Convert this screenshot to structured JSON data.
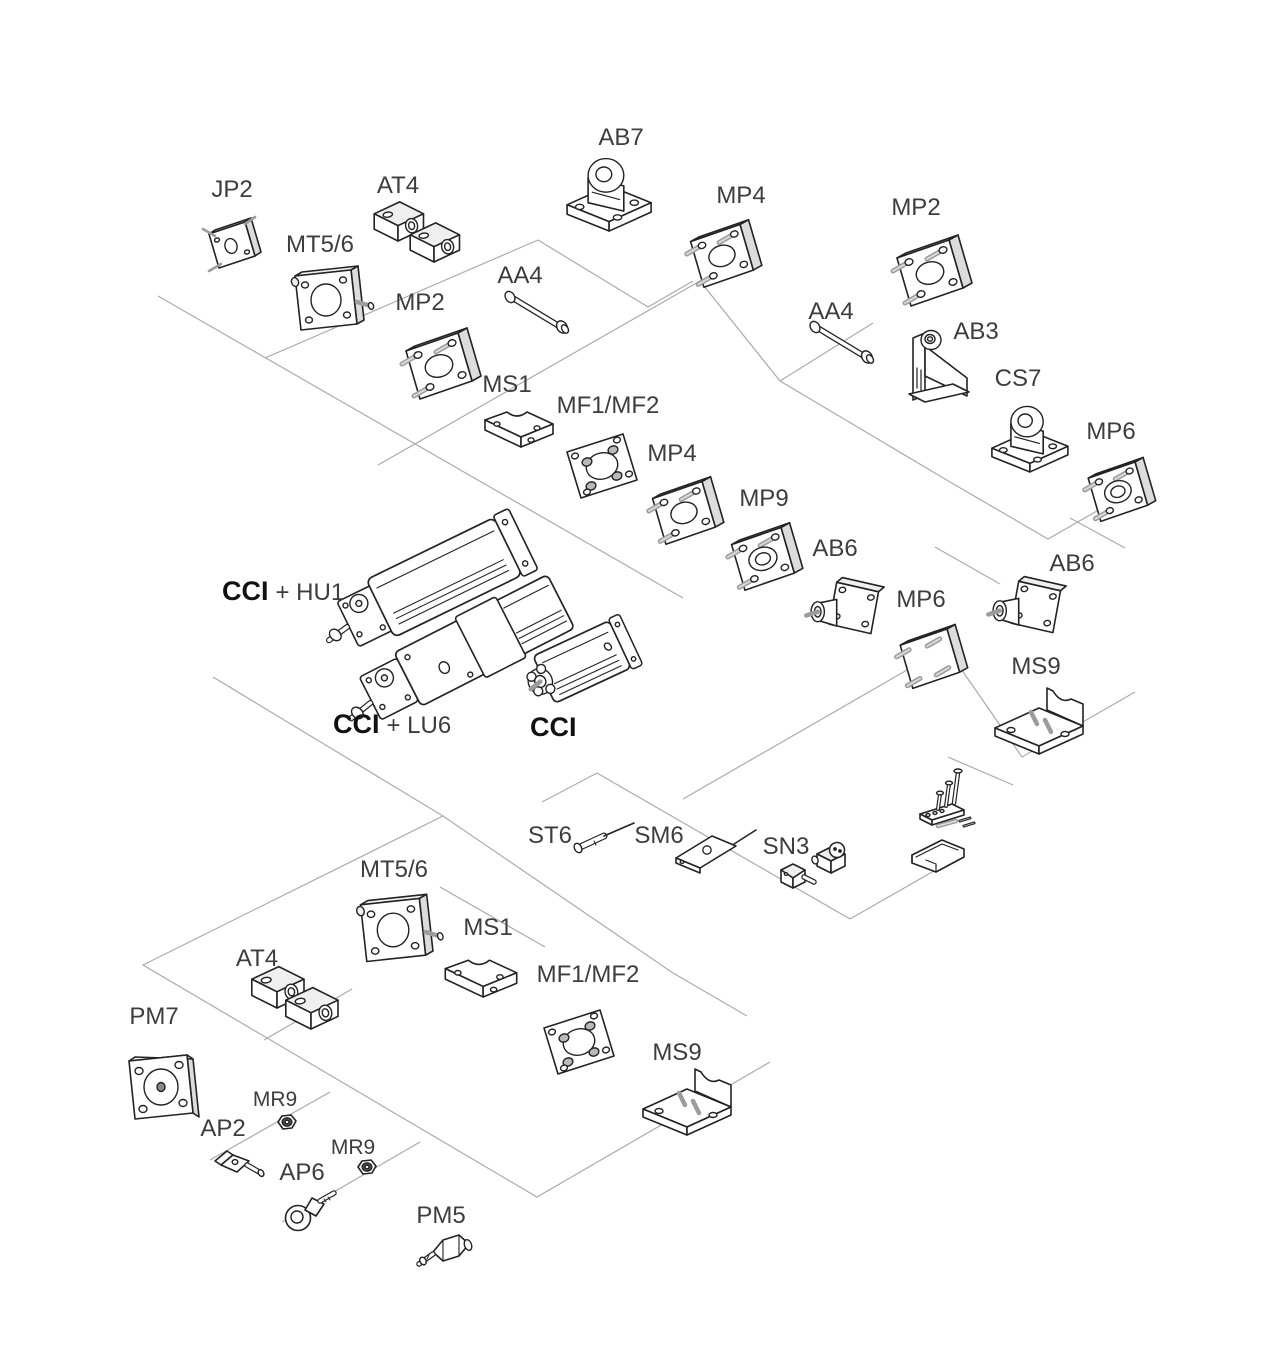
{
  "canvas": {
    "width": 1280,
    "height": 1347,
    "background": "#ffffff"
  },
  "style": {
    "connector_color": "#ababab",
    "outline_color": "#232323",
    "label_color": "#3d3d3d",
    "bold_label_color": "#111111",
    "label_font_size": 24,
    "small_label_font_size": 21,
    "bold_label_font_size": 27,
    "shade_light": "#efefef",
    "shade_mid": "#dcdcdc",
    "metal_gray": "#9c9c9c"
  },
  "labels": [
    {
      "id": "jp2",
      "text": "JP2",
      "x": 232,
      "y": 197,
      "anchor": "middle"
    },
    {
      "id": "mt56-top",
      "text": "MT5/6",
      "x": 320,
      "y": 252,
      "anchor": "middle"
    },
    {
      "id": "at4-top",
      "text": "AT4",
      "x": 398,
      "y": 193,
      "anchor": "middle"
    },
    {
      "id": "ab7",
      "text": "AB7",
      "x": 621,
      "y": 145,
      "anchor": "middle"
    },
    {
      "id": "mp4-top",
      "text": "MP4",
      "x": 741,
      "y": 203,
      "anchor": "middle"
    },
    {
      "id": "mp2-topright",
      "text": "MP2",
      "x": 916,
      "y": 215,
      "anchor": "middle"
    },
    {
      "id": "aa4-left",
      "text": "AA4",
      "x": 520,
      "y": 283,
      "anchor": "middle"
    },
    {
      "id": "mp2-left",
      "text": "MP2",
      "x": 420,
      "y": 310,
      "anchor": "middle"
    },
    {
      "id": "aa4-right",
      "text": "AA4",
      "x": 831,
      "y": 319,
      "anchor": "middle"
    },
    {
      "id": "ab3",
      "text": "AB3",
      "x": 976,
      "y": 339,
      "anchor": "middle"
    },
    {
      "id": "cs7",
      "text": "CS7",
      "x": 1018,
      "y": 386,
      "anchor": "middle"
    },
    {
      "id": "mp6-right",
      "text": "MP6",
      "x": 1111,
      "y": 439,
      "anchor": "middle"
    },
    {
      "id": "ms1-top",
      "text": "MS1",
      "x": 507,
      "y": 392,
      "anchor": "middle"
    },
    {
      "id": "mf12-top",
      "text": "MF1/MF2",
      "x": 608,
      "y": 413,
      "anchor": "middle"
    },
    {
      "id": "mp4-mid",
      "text": "MP4",
      "x": 672,
      "y": 461,
      "anchor": "middle"
    },
    {
      "id": "mp9",
      "text": "MP9",
      "x": 764,
      "y": 506,
      "anchor": "middle"
    },
    {
      "id": "ab6-mid",
      "text": "AB6",
      "x": 835,
      "y": 556,
      "anchor": "middle"
    },
    {
      "id": "mp6-mid",
      "text": "MP6",
      "x": 921,
      "y": 607,
      "anchor": "middle"
    },
    {
      "id": "ab6-right",
      "text": "AB6",
      "x": 1072,
      "y": 571,
      "anchor": "middle"
    },
    {
      "id": "ms9-right",
      "text": "MS9",
      "x": 1036,
      "y": 674,
      "anchor": "middle"
    },
    {
      "id": "cci-hu1",
      "segments": [
        {
          "text": "CCI",
          "bold": true
        },
        {
          "text": "+ HU1",
          "bold": false
        }
      ],
      "x": 222,
      "y": 600,
      "anchor": "start"
    },
    {
      "id": "cci-lu6",
      "segments": [
        {
          "text": "CCI",
          "bold": true
        },
        {
          "text": "+ LU6",
          "bold": false
        }
      ],
      "x": 333,
      "y": 733,
      "anchor": "start"
    },
    {
      "id": "cci",
      "segments": [
        {
          "text": "CCI",
          "bold": true
        }
      ],
      "x": 530,
      "y": 736,
      "anchor": "start"
    },
    {
      "id": "st6",
      "text": "ST6",
      "x": 550,
      "y": 843,
      "anchor": "middle"
    },
    {
      "id": "sm6",
      "text": "SM6",
      "x": 659,
      "y": 843,
      "anchor": "middle"
    },
    {
      "id": "sn3",
      "text": "SN3",
      "x": 786,
      "y": 854,
      "anchor": "middle"
    },
    {
      "id": "mt56-bot",
      "text": "MT5/6",
      "x": 394,
      "y": 877,
      "anchor": "middle"
    },
    {
      "id": "ms1-bot",
      "text": "MS1",
      "x": 488,
      "y": 935,
      "anchor": "middle"
    },
    {
      "id": "at4-bot",
      "text": "AT4",
      "x": 257,
      "y": 966,
      "anchor": "middle"
    },
    {
      "id": "pm7",
      "text": "PM7",
      "x": 154,
      "y": 1024,
      "anchor": "middle"
    },
    {
      "id": "mr9-1",
      "text": "MR9",
      "x": 275,
      "y": 1106,
      "anchor": "middle",
      "size": "small"
    },
    {
      "id": "ap2",
      "text": "AP2",
      "x": 223,
      "y": 1136,
      "anchor": "middle"
    },
    {
      "id": "mr9-2",
      "text": "MR9",
      "x": 353,
      "y": 1154,
      "anchor": "middle",
      "size": "small"
    },
    {
      "id": "ap6",
      "text": "AP6",
      "x": 302,
      "y": 1180,
      "anchor": "middle"
    },
    {
      "id": "pm5",
      "text": "PM5",
      "x": 441,
      "y": 1223,
      "anchor": "middle"
    },
    {
      "id": "mf12-bot",
      "text": "MF1/MF2",
      "x": 588,
      "y": 982,
      "anchor": "middle"
    },
    {
      "id": "ms9-bot",
      "text": "MS9",
      "x": 677,
      "y": 1060,
      "anchor": "middle"
    }
  ],
  "parts": [
    {
      "id": "jp2",
      "glyph": "plate-sm",
      "x": 231,
      "y": 248,
      "scale": 1.0
    },
    {
      "id": "mt56-top",
      "glyph": "mt56",
      "x": 325,
      "y": 300,
      "scale": 1.0
    },
    {
      "id": "at4-top-a",
      "glyph": "block",
      "x": 398,
      "y": 224,
      "scale": 0.85
    },
    {
      "id": "at4-top-b",
      "glyph": "block",
      "x": 434,
      "y": 245,
      "scale": 0.85
    },
    {
      "id": "mp2-left",
      "glyph": "flange",
      "x": 438,
      "y": 363,
      "scale": 1.0
    },
    {
      "id": "aa4-left",
      "glyph": "pin",
      "x": 539,
      "y": 312,
      "scale": 1.0
    },
    {
      "id": "ms1-top",
      "glyph": "angle-sm",
      "x": 519,
      "y": 428,
      "scale": 1.0
    },
    {
      "id": "mf12-top",
      "glyph": "flange-flat",
      "x": 601,
      "y": 466,
      "scale": 1.0
    },
    {
      "id": "ab7",
      "glyph": "foot",
      "x": 607,
      "y": 188,
      "scale": 1.05
    },
    {
      "id": "mp4-top",
      "glyph": "flange",
      "x": 721,
      "y": 253,
      "scale": 0.95
    },
    {
      "id": "aa4-right",
      "glyph": "pin",
      "x": 844,
      "y": 342,
      "scale": 1.0
    },
    {
      "id": "mp2-topright",
      "glyph": "flange",
      "x": 929,
      "y": 270,
      "scale": 1.0
    },
    {
      "id": "ab3",
      "glyph": "clevis",
      "x": 937,
      "y": 370,
      "scale": 1.0
    },
    {
      "id": "cs7",
      "glyph": "foot",
      "x": 1028,
      "y": 433,
      "scale": 0.95
    },
    {
      "id": "mp6-right",
      "glyph": "flange-hub",
      "x": 1117,
      "y": 489,
      "scale": 0.9
    },
    {
      "id": "mp4-mid",
      "glyph": "flange",
      "x": 683,
      "y": 510,
      "scale": 0.95
    },
    {
      "id": "mp9",
      "glyph": "flange-hub",
      "x": 762,
      "y": 556,
      "scale": 0.95
    },
    {
      "id": "ab6-mid",
      "glyph": "flange-boss",
      "x": 850,
      "y": 607,
      "scale": 0.95
    },
    {
      "id": "mp6-mid",
      "glyph": "flange-plain",
      "x": 929,
      "y": 656,
      "scale": 0.9
    },
    {
      "id": "ab6-right",
      "glyph": "flange-boss",
      "x": 1032,
      "y": 606,
      "scale": 0.95
    },
    {
      "id": "ms9-right",
      "glyph": "bracket-l",
      "x": 1039,
      "y": 718,
      "scale": 1.0
    },
    {
      "id": "cyl-hu1",
      "glyph": "cyl-lg",
      "x": 445,
      "y": 577,
      "scale": 1.0,
      "rotate": -26
    },
    {
      "id": "cyl-lu6",
      "glyph": "cyl-xl",
      "x": 495,
      "y": 635,
      "scale": 1.0,
      "rotate": -27
    },
    {
      "id": "cyl-cci",
      "glyph": "cyl-sm",
      "x": 582,
      "y": 662,
      "scale": 1.0,
      "rotate": -25
    },
    {
      "id": "st6",
      "glyph": "sensor-rod",
      "x": 600,
      "y": 838,
      "scale": 1.0
    },
    {
      "id": "sm6",
      "glyph": "sensor-flat",
      "x": 706,
      "y": 842,
      "scale": 1.0
    },
    {
      "id": "sn3",
      "glyph": "switch",
      "x": 815,
      "y": 866,
      "scale": 1.0
    },
    {
      "id": "hw-kit",
      "glyph": "hw-kit",
      "x": 942,
      "y": 806,
      "scale": 1.0
    },
    {
      "id": "clamp",
      "glyph": "clamp-profile",
      "x": 938,
      "y": 853,
      "scale": 1.0
    },
    {
      "id": "mt56-bot",
      "glyph": "mt56",
      "x": 392,
      "y": 930,
      "scale": 1.05
    },
    {
      "id": "ms1-bot",
      "glyph": "angle-sm",
      "x": 481,
      "y": 977,
      "scale": 1.05
    },
    {
      "id": "at4-bot-a",
      "glyph": "block",
      "x": 277,
      "y": 990,
      "scale": 0.9
    },
    {
      "id": "at4-bot-b",
      "glyph": "block",
      "x": 311,
      "y": 1011,
      "scale": 0.9
    },
    {
      "id": "pm7",
      "glyph": "plate-flat",
      "x": 161,
      "y": 1087,
      "scale": 1.0
    },
    {
      "id": "mr9-1",
      "glyph": "nut",
      "x": 287,
      "y": 1122,
      "scale": 1.0
    },
    {
      "id": "ap2",
      "glyph": "rod-clevis",
      "x": 237,
      "y": 1163,
      "scale": 1.0
    },
    {
      "id": "mr9-2",
      "glyph": "nut",
      "x": 367,
      "y": 1167,
      "scale": 1.0
    },
    {
      "id": "ap6",
      "glyph": "rod-eye",
      "x": 306,
      "y": 1210,
      "scale": 1.0
    },
    {
      "id": "pm5",
      "glyph": "inline-valve",
      "x": 447,
      "y": 1252,
      "scale": 1.0
    },
    {
      "id": "mf12-bot",
      "glyph": "flange-flat",
      "x": 578,
      "y": 1042,
      "scale": 1.0
    },
    {
      "id": "ms9-bot",
      "glyph": "bracket-l",
      "x": 687,
      "y": 1099,
      "scale": 1.0
    }
  ],
  "connectors": [
    {
      "id": "c1",
      "points": [
        [
          158,
          296
        ],
        [
          683,
          598
        ]
      ]
    },
    {
      "id": "c2",
      "points": [
        [
          265,
          358
        ],
        [
          538,
          240
        ],
        [
          648,
          307
        ],
        [
          693,
          281
        ]
      ]
    },
    {
      "id": "c3",
      "points": [
        [
          378,
          465
        ],
        [
          700,
          281
        ],
        [
          780,
          381
        ],
        [
          873,
          323
        ]
      ]
    },
    {
      "id": "c4",
      "points": [
        [
          780,
          381
        ],
        [
          950,
          482
        ],
        [
          1048,
          539
        ],
        [
          1137,
          488
        ]
      ]
    },
    {
      "id": "c5",
      "points": [
        [
          935,
          547
        ],
        [
          1000,
          584
        ]
      ]
    },
    {
      "id": "c6",
      "points": [
        [
          948,
          650
        ],
        [
          1022,
          757
        ],
        [
          1135,
          692
        ]
      ]
    },
    {
      "id": "c7",
      "points": [
        [
          213,
          677
        ],
        [
          443,
          816
        ]
      ]
    },
    {
      "id": "c8",
      "points": [
        [
          443,
          816
        ],
        [
          143,
          965
        ],
        [
          537,
          1197
        ],
        [
          770,
          1062
        ]
      ]
    },
    {
      "id": "c9",
      "points": [
        [
          443,
          816
        ],
        [
          673,
          973
        ],
        [
          747,
          1016
        ]
      ]
    },
    {
      "id": "c10",
      "points": [
        [
          264,
          1040
        ],
        [
          352,
          989
        ]
      ]
    },
    {
      "id": "c11",
      "points": [
        [
          440,
          887
        ],
        [
          545,
          947
        ]
      ]
    },
    {
      "id": "c12",
      "points": [
        [
          210,
          1160
        ],
        [
          330,
          1092
        ]
      ]
    },
    {
      "id": "c13",
      "points": [
        [
          282,
          1222
        ],
        [
          420,
          1142
        ]
      ]
    },
    {
      "id": "c14",
      "points": [
        [
          542,
          802
        ],
        [
          597,
          773
        ],
        [
          850,
          919
        ]
      ]
    },
    {
      "id": "c15",
      "points": [
        [
          850,
          919
        ],
        [
          960,
          856
        ]
      ]
    },
    {
      "id": "c16",
      "points": [
        [
          683,
          799
        ],
        [
          940,
          651
        ]
      ]
    },
    {
      "id": "c17",
      "points": [
        [
          948,
          757
        ],
        [
          1013,
          785
        ]
      ]
    },
    {
      "id": "c18",
      "points": [
        [
          1070,
          518
        ],
        [
          1125,
          548
        ]
      ]
    }
  ]
}
